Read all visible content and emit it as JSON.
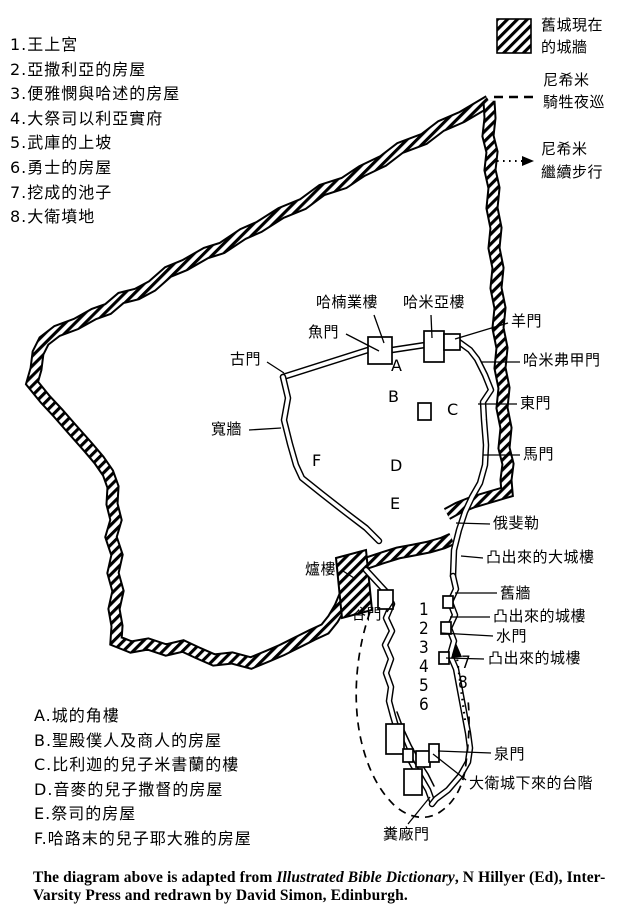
{
  "legend": {
    "items": [
      {
        "symbol": "hatched-wall-swatch",
        "line1": "舊城現在",
        "line2": "的城牆"
      },
      {
        "symbol": "dashed-line",
        "line1": "尼希米",
        "line2": "騎牲夜巡"
      },
      {
        "symbol": "dotted-arrow",
        "line1": "尼希米",
        "line2": "繼續步行"
      }
    ]
  },
  "numbered_list": [
    "1.王上宮",
    "2.亞撒利亞的房屋",
    "3.便雅憫與哈述的房屋",
    "4.大祭司以利亞實府",
    "5.武庫的上坡",
    "6.勇士的房屋",
    "7.挖成的池子",
    "8.大衛墳地"
  ],
  "lettered_list": [
    "A.城的角樓",
    "B.聖殿僕人及商人的房屋",
    "C.比利迦的兒子米書蘭的樓",
    "D.音麥的兒子撒督的房屋",
    "E.祭司的房屋",
    "F.哈路末的兒子耶大雅的房屋"
  ],
  "map_labels": {
    "hananel_tower": "哈楠業樓",
    "hammeah_tower": "哈米亞樓",
    "fish_gate": "魚門",
    "old_gate": "古門",
    "broad_wall": "寬牆",
    "sheep_gate": "羊門",
    "hammiphkad_gate": "哈米弗甲門",
    "east_gate": "東門",
    "horse_gate": "馬門",
    "ophel": "俄斐勒",
    "great_projecting_tower": "凸出來的大城樓",
    "old_wall": "舊牆",
    "projecting_tower_upper": "凸出來的城樓",
    "water_gate": "水門",
    "projecting_tower_lower": "凸出來的城樓",
    "furnace_tower": "爐樓",
    "valley_gate": "谷門",
    "fountain_gate": "泉門",
    "steps_from_city_of_david": "大衛城下來的台階",
    "dung_gate": "糞廠門"
  },
  "map_letters": [
    "A",
    "B",
    "C",
    "D",
    "E",
    "F"
  ],
  "map_numbers": [
    "1",
    "2",
    "3",
    "4",
    "5",
    "6",
    "7",
    "8"
  ],
  "caption": {
    "text_before_italic": "The diagram above is adapted from ",
    "italic": "Illustrated Bible Dictionary",
    "text_after_italic": ", N Hillyer (Ed), Inter-Varsity Press and redrawn by David Simon, Edinburgh."
  },
  "colors": {
    "ink": "#000000",
    "paper": "#ffffff"
  }
}
